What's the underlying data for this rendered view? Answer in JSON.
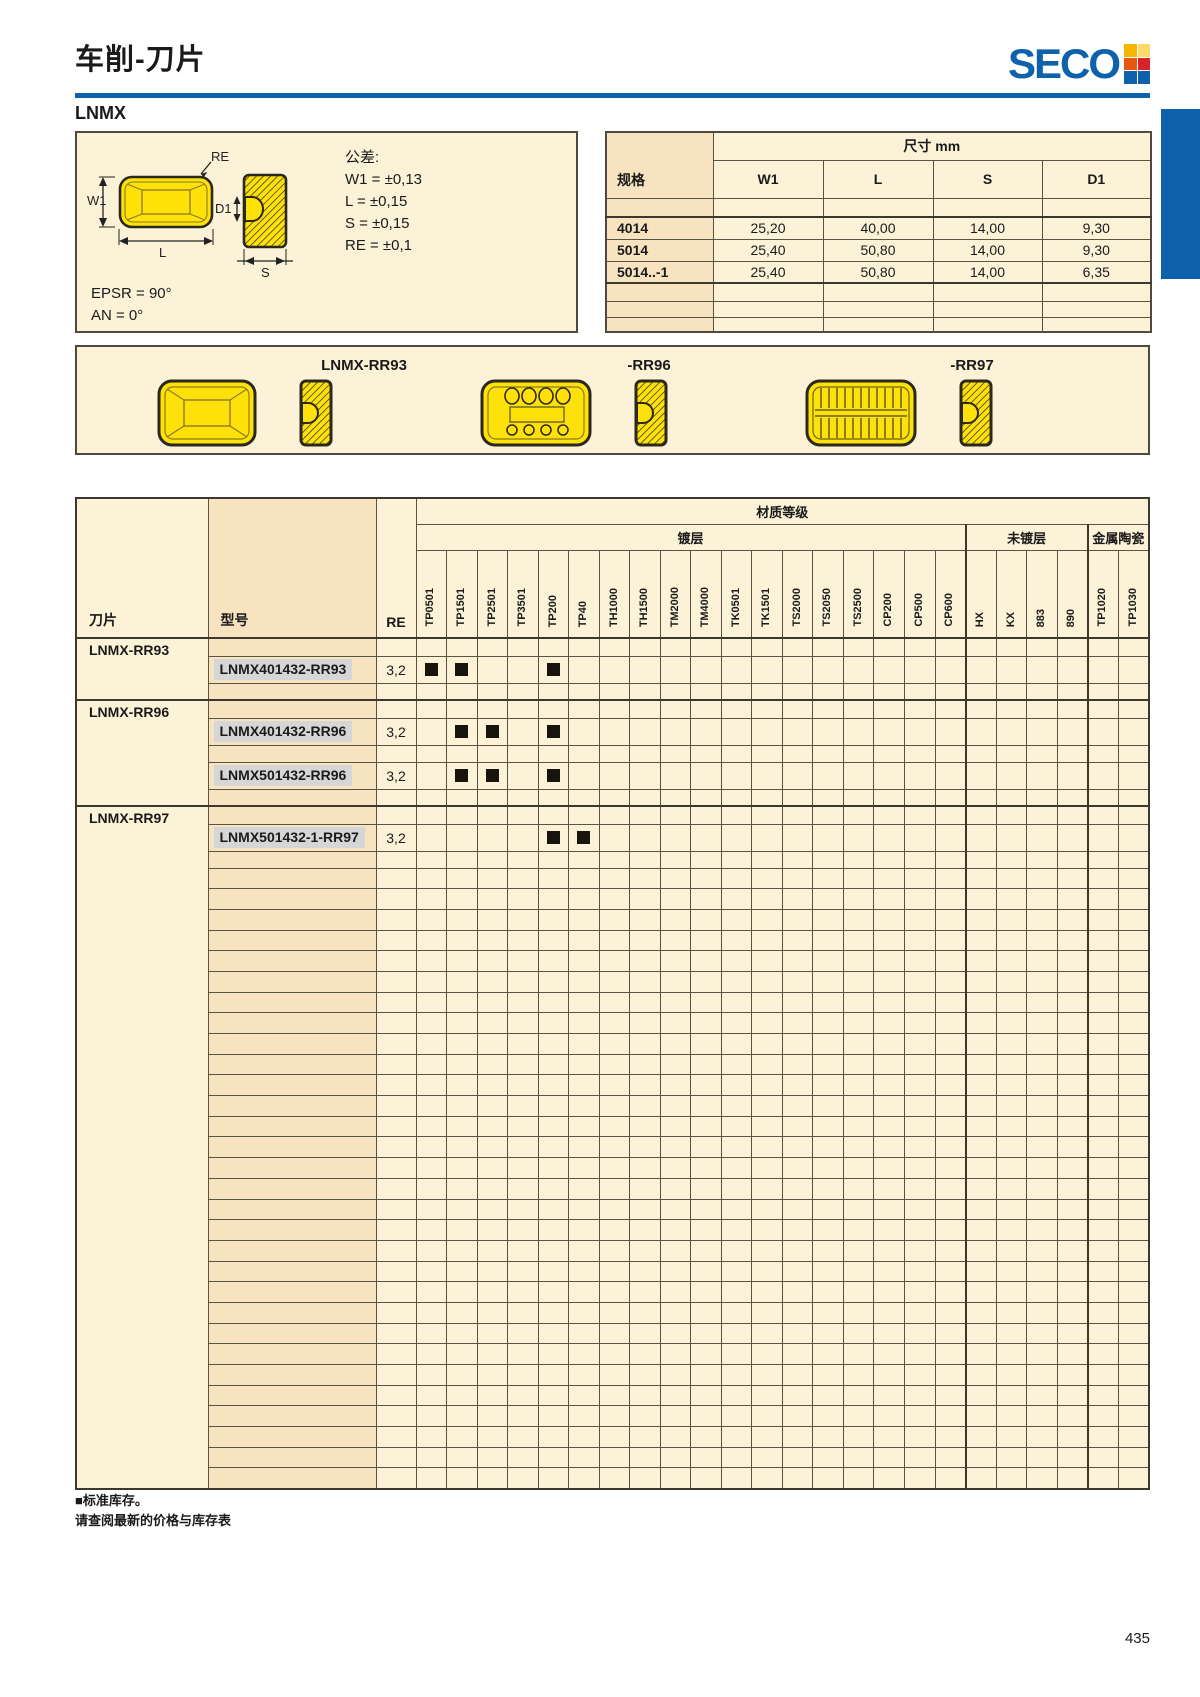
{
  "page_number": "435",
  "header": {
    "title": "车削-刀片",
    "brand": "SECO",
    "logo_squares": [
      "#F6B600",
      "#FCD96A",
      "#E9560D",
      "#D8232A",
      "#0E62AB",
      "#0E62AB"
    ]
  },
  "section_label": "LNMX",
  "colors": {
    "accent_blue": "#0E62AB",
    "insert_yellow": "#FFE10A",
    "page_beige": "#FBF2D7",
    "column_beige": "#F8E3C0",
    "mark_black": "#17140E",
    "model_highlight": "#D6D6D6"
  },
  "tolerance_box": {
    "title": "公差:",
    "items": [
      "W1 = ±0,13",
      "L = ±0,15",
      "S = ±0,15",
      "RE = ±0,1"
    ],
    "angles": [
      "EPSR = 90°",
      "AN = 0°"
    ],
    "diagram_labels": {
      "re": "RE",
      "w1": "W1",
      "l": "L",
      "d1": "D1",
      "s": "S"
    }
  },
  "dimensions_table": {
    "title": "尺寸 mm",
    "spec_header": "规格",
    "columns": [
      "W1",
      "L",
      "S",
      "D1"
    ],
    "rows": [
      {
        "spec": "4014",
        "values": [
          "25,20",
          "40,00",
          "14,00",
          "9,30"
        ]
      },
      {
        "spec": "5014",
        "values": [
          "25,40",
          "50,80",
          "14,00",
          "9,30"
        ]
      },
      {
        "spec": "5014..-1",
        "values": [
          "25,40",
          "50,80",
          "14,00",
          "6,35"
        ]
      }
    ]
  },
  "profiles": {
    "labels": [
      "LNMX-RR93",
      "-RR96",
      "-RR97"
    ]
  },
  "grades_table": {
    "header": "材质等级",
    "insert_header": "刀片",
    "model_header": "型号",
    "re_header": "RE",
    "groups": [
      {
        "label": "镀层",
        "columns": [
          "TP0501",
          "TP1501",
          "TP2501",
          "TP3501",
          "TP200",
          "TP40",
          "TH1000",
          "TH1500",
          "TM2000",
          "TM4000",
          "TK0501",
          "TK1501",
          "TS2000",
          "TS2050",
          "TS2500",
          "CP200",
          "CP500",
          "CP600"
        ]
      },
      {
        "label": "未镀层",
        "columns": [
          "HX",
          "KX",
          "883",
          "890"
        ]
      },
      {
        "label": "金属陶瓷",
        "columns": [
          "TP1020",
          "TP1030"
        ]
      }
    ],
    "row_groups": [
      {
        "label": "LNMX-RR93",
        "models": [
          {
            "name": "LNMX401432-RR93",
            "re": "3,2",
            "marks": [
              "TP0501",
              "TP1501",
              "TP200"
            ]
          }
        ]
      },
      {
        "label": "LNMX-RR96",
        "models": [
          {
            "name": "LNMX401432-RR96",
            "re": "3,2",
            "marks": [
              "TP1501",
              "TP2501",
              "TP200"
            ]
          },
          {
            "name": "LNMX501432-RR96",
            "re": "3,2",
            "marks": [
              "TP1501",
              "TP2501",
              "TP200"
            ]
          }
        ]
      },
      {
        "label": "LNMX-RR97",
        "models": [
          {
            "name": "LNMX501432-1-RR97",
            "re": "3,2",
            "marks": [
              "TP200",
              "TP40"
            ]
          }
        ]
      }
    ],
    "empty_row_count": 30
  },
  "footer": {
    "note_stock": "■标准库存。",
    "note_price": "请查阅最新的价格与库存表"
  }
}
